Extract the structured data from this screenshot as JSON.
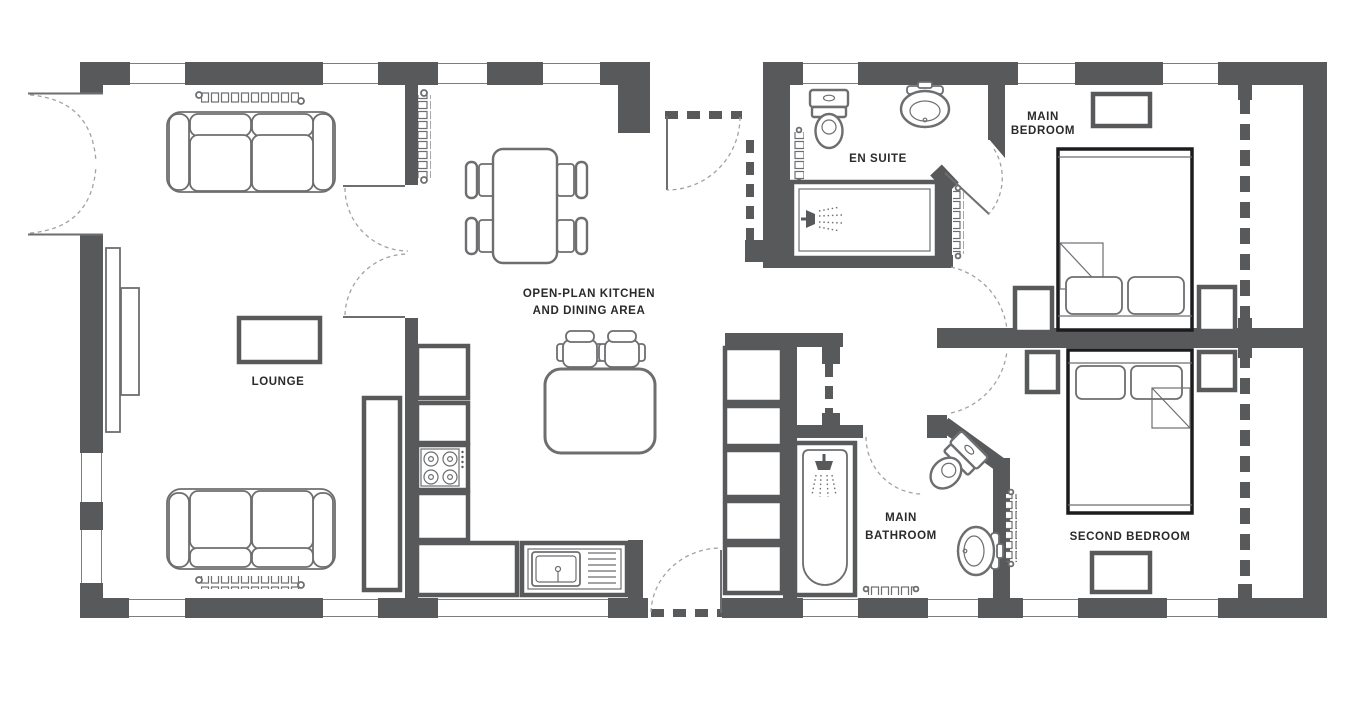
{
  "rooms": {
    "lounge": "LOUNGE",
    "kitchen_line1": "OPEN-PLAN KITCHEN",
    "kitchen_line2": "AND DINING AREA",
    "ensuite": "EN SUITE",
    "main_bedroom_line1": "MAIN",
    "main_bedroom_line2": "BEDROOM",
    "main_bathroom_line1": "MAIN",
    "main_bathroom_line2": "BATHROOM",
    "second_bedroom": "SECOND BEDROOM"
  },
  "colors": {
    "wall": "#58595b",
    "furniture": "#6d6e70",
    "bedline": "#1c1c1e",
    "label": "#2a2a2c",
    "doorarc": "#a2a2a4",
    "background": "#ffffff"
  }
}
